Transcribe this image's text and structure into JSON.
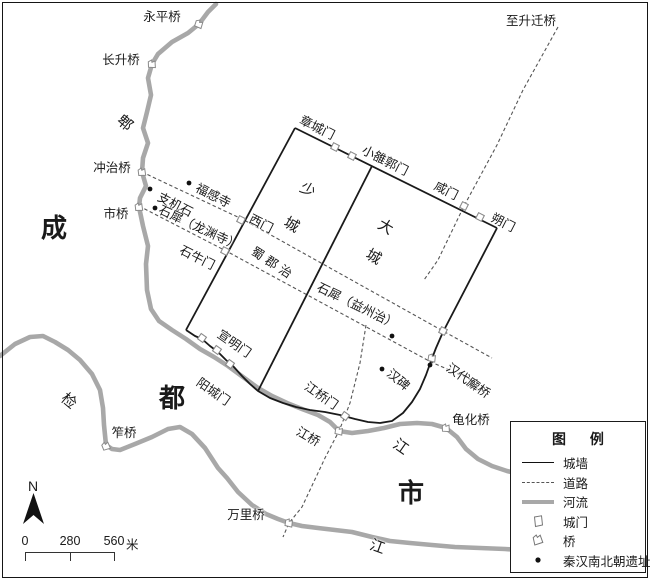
{
  "north_label": "N",
  "scale_bar": {
    "ticks": [
      "0",
      "280",
      "560"
    ],
    "unit": "米"
  },
  "legend": {
    "title": "图 例",
    "items": [
      {
        "type": "wall",
        "label": "城墙"
      },
      {
        "type": "road",
        "label": "道路"
      },
      {
        "type": "river",
        "label": "河流"
      },
      {
        "type": "gate",
        "label": "城门"
      },
      {
        "type": "bridge",
        "label": "桥"
      },
      {
        "type": "site",
        "label": "秦汉南北朝遗址"
      }
    ]
  },
  "colors": {
    "wall": "#1a1a1a",
    "road": "#555555",
    "river": "#a8a8a8",
    "symbol": "#8a8a8a",
    "site": "#111111"
  },
  "geometry": {
    "rivers": [
      {
        "name": "pi-river",
        "points": [
          [
            216,
            4
          ],
          [
            208,
            12
          ],
          [
            199,
            24
          ],
          [
            188,
            33
          ],
          [
            172,
            42
          ],
          [
            158,
            54
          ],
          [
            152,
            64
          ],
          [
            148,
            78
          ],
          [
            151,
            95
          ],
          [
            147,
            112
          ],
          [
            143,
            128
          ],
          [
            148,
            143
          ],
          [
            143,
            158
          ],
          [
            142,
            172
          ],
          [
            146,
            186
          ],
          [
            140,
            198
          ],
          [
            139,
            207
          ],
          [
            143,
            226
          ],
          [
            148,
            246
          ],
          [
            146,
            264
          ],
          [
            147,
            290
          ],
          [
            151,
            309
          ],
          [
            159,
            321
          ],
          [
            172,
            330
          ],
          [
            186,
            339
          ],
          [
            200,
            349
          ],
          [
            214,
            357
          ],
          [
            228,
            366
          ],
          [
            243,
            377
          ],
          [
            258,
            388
          ],
          [
            272,
            396
          ],
          [
            287,
            403
          ],
          [
            302,
            409
          ],
          [
            318,
            415
          ],
          [
            330,
            422
          ],
          [
            339,
            431
          ],
          [
            352,
            433
          ],
          [
            368,
            431
          ],
          [
            384,
            428
          ],
          [
            400,
            424
          ],
          [
            417,
            423
          ],
          [
            432,
            424
          ],
          [
            446,
            428
          ],
          [
            457,
            437
          ],
          [
            466,
            449
          ],
          [
            478,
            459
          ],
          [
            492,
            466
          ],
          [
            507,
            471
          ],
          [
            520,
            474
          ]
        ]
      },
      {
        "name": "jian-river",
        "points": [
          [
            0,
            356
          ],
          [
            15,
            344
          ],
          [
            30,
            337
          ],
          [
            43,
            336
          ],
          [
            55,
            342
          ],
          [
            68,
            350
          ],
          [
            80,
            360
          ],
          [
            92,
            374
          ],
          [
            100,
            390
          ],
          [
            103,
            408
          ],
          [
            104,
            425
          ],
          [
            106,
            445
          ],
          [
            112,
            449
          ],
          [
            120,
            450
          ],
          [
            135,
            444
          ],
          [
            152,
            437
          ],
          [
            168,
            429
          ],
          [
            180,
            427
          ],
          [
            192,
            434
          ],
          [
            205,
            448
          ],
          [
            218,
            468
          ],
          [
            227,
            478
          ],
          [
            238,
            492
          ],
          [
            252,
            505
          ],
          [
            266,
            514
          ],
          [
            278,
            519
          ],
          [
            289,
            523
          ],
          [
            302,
            526
          ],
          [
            318,
            528
          ],
          [
            335,
            530
          ],
          [
            352,
            532
          ],
          [
            372,
            537
          ],
          [
            390,
            541
          ],
          [
            410,
            543
          ],
          [
            432,
            545
          ],
          [
            455,
            547
          ],
          [
            480,
            548
          ],
          [
            505,
            549
          ],
          [
            520,
            550
          ]
        ]
      }
    ],
    "roads": [
      {
        "name": "road-west-upper",
        "points": [
          [
            142,
            172
          ],
          [
            244,
            220
          ],
          [
            443,
            331
          ],
          [
            492,
            358
          ]
        ]
      },
      {
        "name": "road-west-lower",
        "points": [
          [
            139,
            206
          ],
          [
            228,
            252
          ],
          [
            431,
            362
          ],
          [
            472,
            380
          ]
        ]
      },
      {
        "name": "road-shengqianqiao",
        "points": [
          [
            558,
            27
          ],
          [
            523,
            90
          ],
          [
            497,
            145
          ],
          [
            464,
            206
          ],
          [
            438,
            260
          ],
          [
            424,
            280
          ]
        ]
      },
      {
        "name": "road-wanliqiao",
        "points": [
          [
            366,
            325
          ],
          [
            360,
            363
          ],
          [
            350,
            403
          ],
          [
            345,
            416
          ],
          [
            339,
            431
          ],
          [
            325,
            458
          ],
          [
            302,
            507
          ],
          [
            289,
            523
          ],
          [
            283,
            537
          ]
        ]
      }
    ],
    "walls": [
      {
        "name": "north-wall",
        "points": [
          [
            295,
            128
          ],
          [
            497,
            228
          ]
        ]
      },
      {
        "name": "west-wall",
        "points": [
          [
            295,
            128
          ],
          [
            186,
            330
          ]
        ]
      },
      {
        "name": "divider-wall",
        "points": [
          [
            372,
            166
          ],
          [
            258,
            391
          ]
        ]
      },
      {
        "name": "south-east-wall",
        "points": [
          [
            186,
            330
          ],
          [
            195,
            336
          ],
          [
            202,
            339
          ],
          [
            210,
            346
          ],
          [
            218,
            352
          ],
          [
            226,
            360
          ],
          [
            233,
            366
          ],
          [
            242,
            376
          ],
          [
            250,
            384
          ],
          [
            258,
            391
          ],
          [
            270,
            398
          ],
          [
            283,
            403
          ],
          [
            296,
            407
          ],
          [
            310,
            410
          ],
          [
            325,
            412
          ],
          [
            340,
            415
          ],
          [
            355,
            419
          ],
          [
            368,
            422
          ],
          [
            380,
            423
          ],
          [
            392,
            421
          ],
          [
            403,
            413
          ],
          [
            412,
            402
          ],
          [
            420,
            389
          ],
          [
            426,
            375
          ],
          [
            431,
            361
          ],
          [
            436,
            348
          ],
          [
            443,
            332
          ],
          [
            497,
            228
          ]
        ]
      }
    ]
  },
  "symbols": {
    "gates": [
      {
        "x": 335,
        "y": 147,
        "rot": 27
      },
      {
        "x": 352,
        "y": 156,
        "rot": 27
      },
      {
        "x": 464,
        "y": 206,
        "rot": 27
      },
      {
        "x": 480,
        "y": 217,
        "rot": 27
      },
      {
        "x": 241,
        "y": 220,
        "rot": 27
      },
      {
        "x": 225,
        "y": 251,
        "rot": 27
      },
      {
        "x": 202,
        "y": 338,
        "rot": 35
      },
      {
        "x": 217,
        "y": 350,
        "rot": 35
      },
      {
        "x": 230,
        "y": 364,
        "rot": 35
      },
      {
        "x": 345,
        "y": 416,
        "rot": 35
      },
      {
        "x": 443,
        "y": 331,
        "rot": 27
      }
    ],
    "bridges": [
      {
        "x": 199,
        "y": 24,
        "rot": 40
      },
      {
        "x": 152,
        "y": 64,
        "rot": 20
      },
      {
        "x": 142,
        "y": 172,
        "rot": 15
      },
      {
        "x": 139,
        "y": 207,
        "rot": 15
      },
      {
        "x": 106,
        "y": 446,
        "rot": 0
      },
      {
        "x": 289,
        "y": 523,
        "rot": 30
      },
      {
        "x": 339,
        "y": 431,
        "rot": 30
      },
      {
        "x": 446,
        "y": 428,
        "rot": 20
      },
      {
        "x": 432,
        "y": 358,
        "rot": 30
      }
    ],
    "sites": [
      {
        "x": 189,
        "y": 183
      },
      {
        "x": 150,
        "y": 189
      },
      {
        "x": 155,
        "y": 208
      },
      {
        "x": 392,
        "y": 336
      },
      {
        "x": 382,
        "y": 369
      },
      {
        "x": 430,
        "y": 365
      }
    ]
  },
  "labels": [
    {
      "name": "yongping-bridge",
      "text": "永平桥",
      "x": 162,
      "y": 17,
      "rot": 0
    },
    {
      "name": "changsheng-bridge",
      "text": "长升桥",
      "x": 121,
      "y": 60,
      "rot": 0
    },
    {
      "name": "pi-river",
      "text": "郫",
      "x": 124,
      "y": 124,
      "rot": 40,
      "size": 15
    },
    {
      "name": "chongzhi-bridge",
      "text": "冲治桥",
      "x": 112,
      "y": 168,
      "rot": 0
    },
    {
      "name": "shi-bridge",
      "text": "市桥",
      "x": 116,
      "y": 214,
      "rot": 0
    },
    {
      "name": "cheng-char",
      "text": "成",
      "x": 54,
      "y": 228,
      "rot": 0,
      "size": 26,
      "bold": true
    },
    {
      "name": "fugan-temple",
      "text": "福感寺",
      "x": 213,
      "y": 196,
      "rot": 27
    },
    {
      "name": "zhijishi",
      "text": "支机石",
      "x": 175,
      "y": 205,
      "rot": 27
    },
    {
      "name": "shixi-longyuansi",
      "text": "石犀（龙渊寺）",
      "x": 199,
      "y": 228,
      "rot": 25
    },
    {
      "name": "shiniu-gate",
      "text": "石牛门",
      "x": 197,
      "y": 258,
      "rot": 27
    },
    {
      "name": "west-gate",
      "text": "西门",
      "x": 261,
      "y": 224,
      "rot": 27
    },
    {
      "name": "zhangcheng-gate",
      "text": "章城门",
      "x": 317,
      "y": 128,
      "rot": 27
    },
    {
      "name": "xiaoluoguo-gate",
      "text": "小雒郭门",
      "x": 385,
      "y": 161,
      "rot": 27
    },
    {
      "name": "xian-gate",
      "text": "咸门",
      "x": 446,
      "y": 191,
      "rot": 27
    },
    {
      "name": "shuo-gate",
      "text": "朔门",
      "x": 503,
      "y": 223,
      "rot": 27
    },
    {
      "name": "to-shengqian-bridge",
      "text": "至升迁桥",
      "x": 531,
      "y": 21,
      "rot": 0
    },
    {
      "name": "shaocheng-shao",
      "text": "少",
      "x": 307,
      "y": 191,
      "rot": 30,
      "size": 15
    },
    {
      "name": "shaocheng-cheng",
      "text": "城",
      "x": 291,
      "y": 226,
      "rot": 30,
      "size": 15
    },
    {
      "name": "dacheng-da",
      "text": "大",
      "x": 385,
      "y": 228,
      "rot": 30,
      "size": 15
    },
    {
      "name": "dacheng-cheng",
      "text": "城",
      "x": 373,
      "y": 258,
      "rot": 30,
      "size": 15
    },
    {
      "name": "shujun-seat",
      "text": "蜀郡治",
      "x": 273,
      "y": 264,
      "rot": 33,
      "spread": true
    },
    {
      "name": "shixi-yizhou-seat",
      "text": "石犀（益州治）",
      "x": 357,
      "y": 306,
      "rot": 26
    },
    {
      "name": "han-stele",
      "text": "汉碑",
      "x": 398,
      "y": 380,
      "rot": 40
    },
    {
      "name": "handai-xie-bridge",
      "text": "汉代廨桥",
      "x": 468,
      "y": 381,
      "rot": 35
    },
    {
      "name": "xuanming-gate",
      "text": "宣明门",
      "x": 234,
      "y": 344,
      "rot": 35
    },
    {
      "name": "yangcheng-gate",
      "text": "阳城门",
      "x": 213,
      "y": 392,
      "rot": 35
    },
    {
      "name": "jiangqiao-gate",
      "text": "江桥门",
      "x": 321,
      "y": 396,
      "rot": 35
    },
    {
      "name": "jiang-bridge",
      "text": "江桥",
      "x": 308,
      "y": 437,
      "rot": 30
    },
    {
      "name": "du-char",
      "text": "都",
      "x": 172,
      "y": 398,
      "rot": 0,
      "size": 26,
      "bold": true
    },
    {
      "name": "jian-river",
      "text": "检",
      "x": 68,
      "y": 402,
      "rot": 40,
      "size": 15
    },
    {
      "name": "zuo-bridge",
      "text": "笮桥",
      "x": 124,
      "y": 433,
      "rot": 0
    },
    {
      "name": "wanli-bridge",
      "text": "万里桥",
      "x": 246,
      "y": 515,
      "rot": 0
    },
    {
      "name": "guihua-bridge",
      "text": "龟化桥",
      "x": 471,
      "y": 420,
      "rot": 0
    },
    {
      "name": "jiang-east",
      "text": "江",
      "x": 400,
      "y": 448,
      "rot": 35,
      "size": 15
    },
    {
      "name": "shi-char",
      "text": "市",
      "x": 411,
      "y": 493,
      "rot": 0,
      "size": 26,
      "bold": true
    },
    {
      "name": "jiang-south",
      "text": "江",
      "x": 377,
      "y": 548,
      "rot": 20,
      "size": 15
    }
  ]
}
